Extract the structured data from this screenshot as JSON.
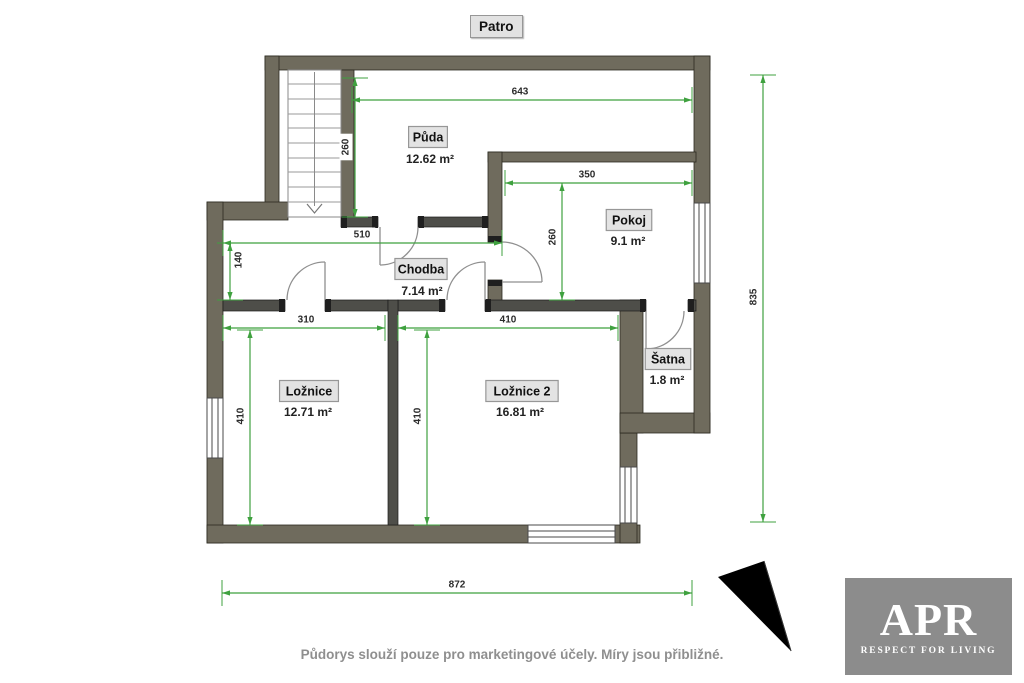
{
  "title": "Patro",
  "disclaimer": "Půdorys slouží pouze pro marketingové účely. Míry jsou přibližné.",
  "logo": {
    "text": "APR",
    "tagline": "RESPECT FOR LIVING"
  },
  "rooms": [
    {
      "name": "Půda",
      "area": "12.62 m²"
    },
    {
      "name": "Pokoj",
      "area": "9.1 m²"
    },
    {
      "name": "Chodba",
      "area": "7.14 m²"
    },
    {
      "name": "Ložnice",
      "area": "12.71 m²"
    },
    {
      "name": "Ložnice 2",
      "area": "16.81 m²"
    },
    {
      "name": "Šatna",
      "area": "1.8 m²"
    }
  ],
  "dimensions": [
    "643",
    "260",
    "350",
    "260",
    "510",
    "140",
    "310",
    "410",
    "410",
    "410",
    "872",
    "835"
  ],
  "colors": {
    "wall": "#6f6b5d",
    "partition": "#4e4e49",
    "wall_cap": "#1f1f1f",
    "dimension": "#3fa13f",
    "label_box": "#e3e3e3",
    "logo_bg": "#8c8c8c"
  }
}
